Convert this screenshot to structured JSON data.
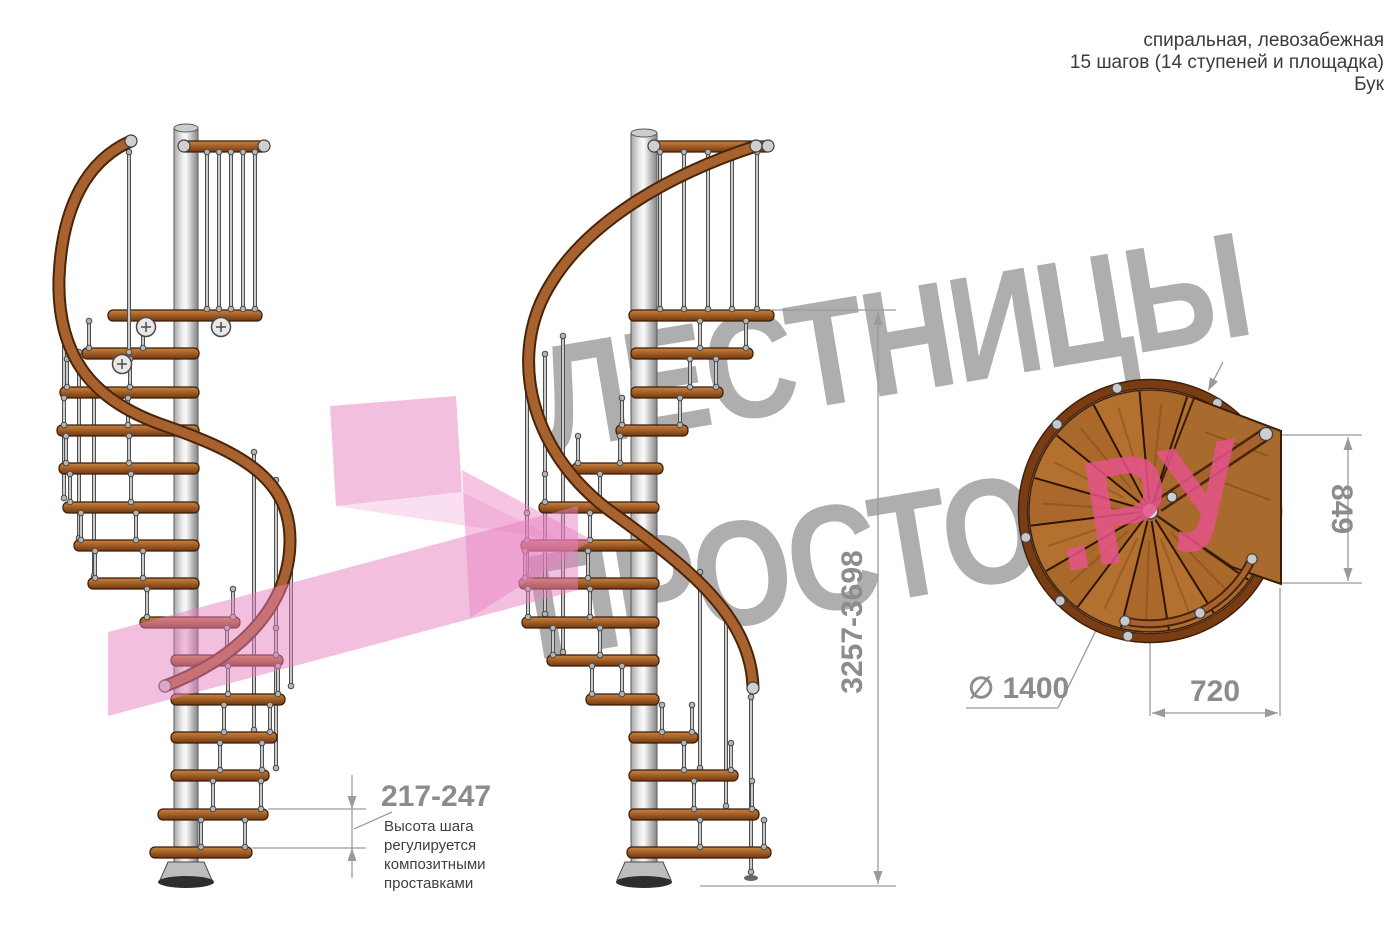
{
  "header": {
    "line1": "спиральная, левозабежная",
    "line2": "15 шагов (14 ступеней и площадка)",
    "line3": "Бук"
  },
  "watermark": {
    "word_top": "ЛЕСТНИЦЫ",
    "word_bottom_gray": "ПРОСТО",
    "word_bottom_pink": ".РУ"
  },
  "dimensions": {
    "step_height_range": "217-247",
    "step_height_note_lines": [
      "Высота шага",
      "регулируется",
      "композитными",
      "проставками"
    ],
    "total_height_range": "3257-3698",
    "landing_depth": "849",
    "landing_width": "720",
    "diameter": "∅ 1400"
  },
  "colors": {
    "watermark_gray": "#9b9b9b",
    "watermark_pink": "#e6538a",
    "arrow_pink": "#e87fc0",
    "dim_gray": "#9a9a9a",
    "dim_text": "#8c8c8c",
    "note_text": "#3f3f3f",
    "wood_light": "#c98440",
    "wood_mid": "#9c5a24",
    "wood_dark": "#74380f",
    "rail_dark": "#4a2408",
    "rail_light": "#a8622f",
    "disc_wood": "#b4702f",
    "steel_light": "#d8d8d8",
    "steel_dark": "#4f4f4f"
  }
}
